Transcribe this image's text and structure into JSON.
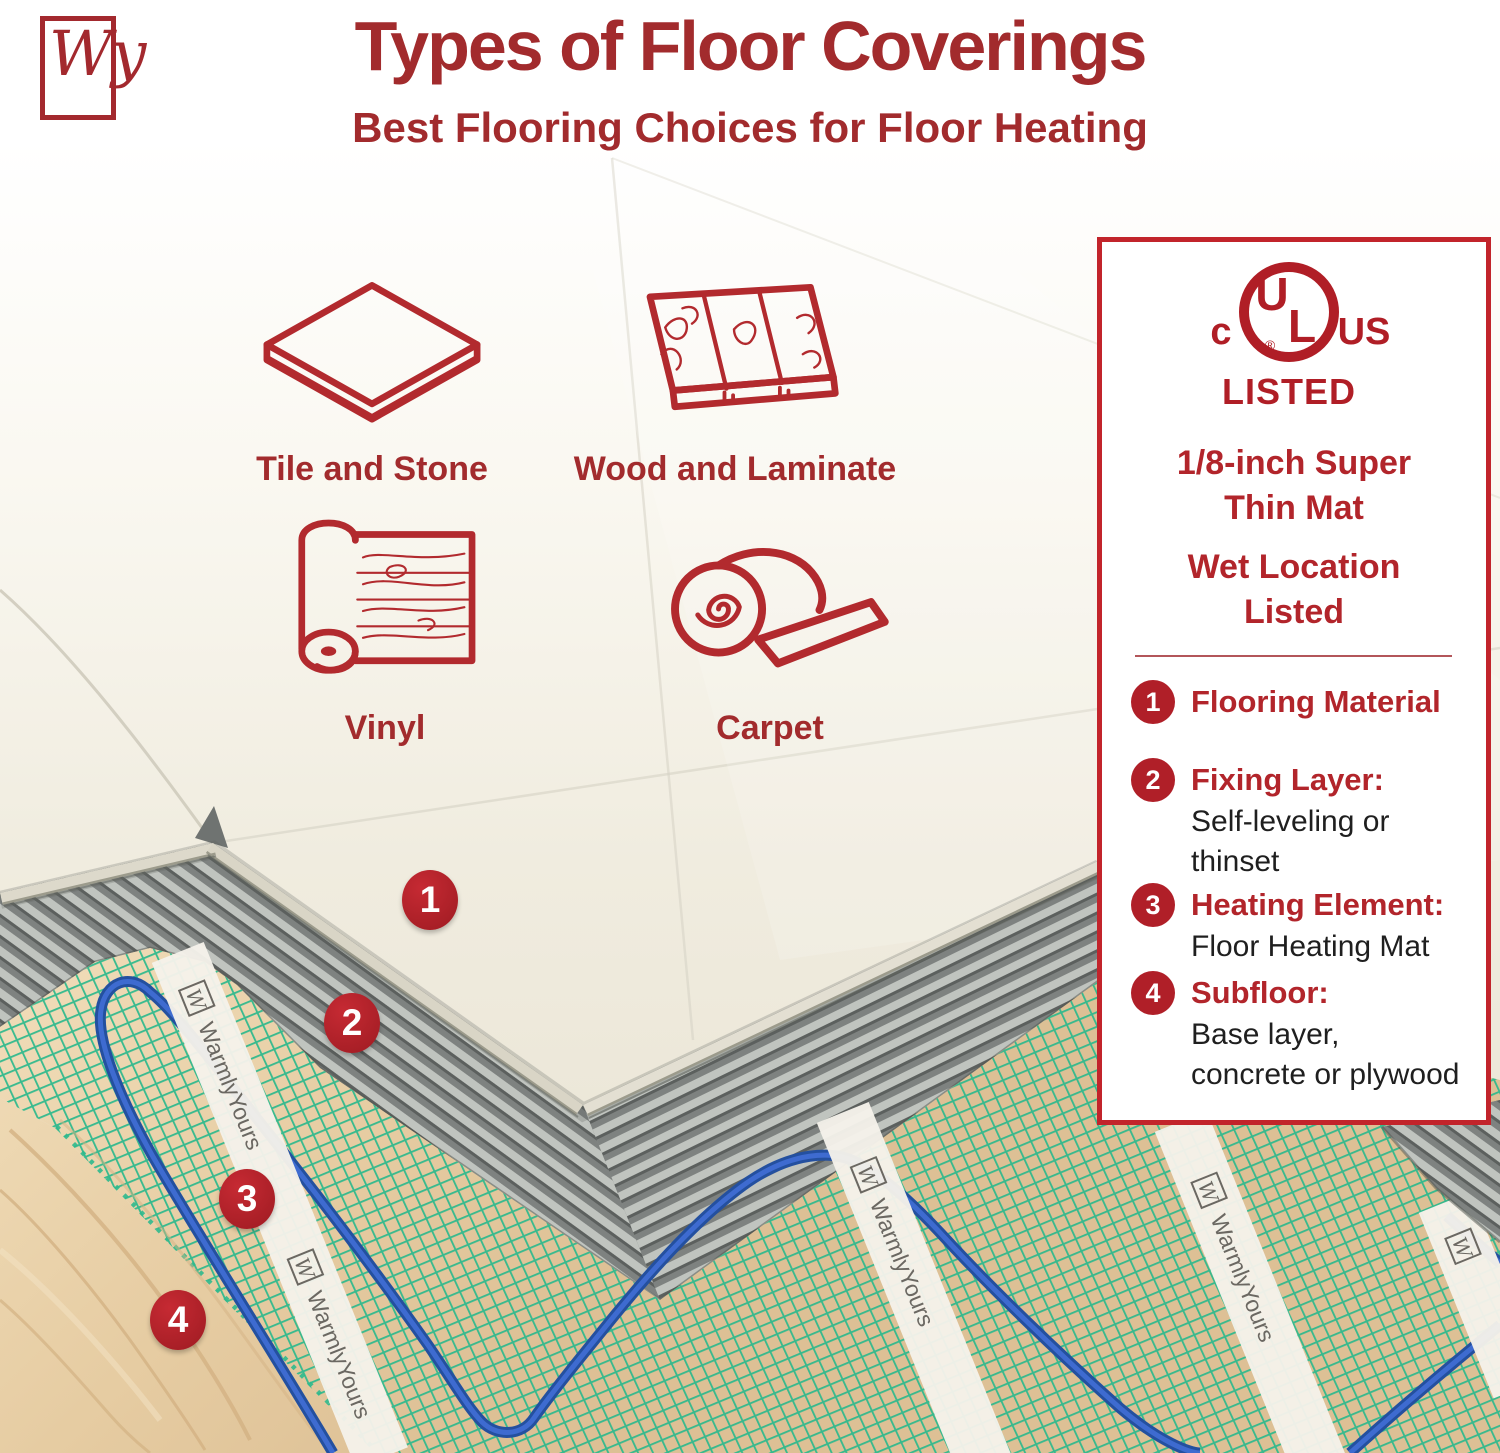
{
  "brand": {
    "logo_monogram": "Wy",
    "name": "WarmlyYours"
  },
  "header": {
    "title": "Types of Floor Coverings",
    "subtitle": "Best Flooring Choices for Floor Heating"
  },
  "flooring_types": [
    {
      "label": "Tile and Stone",
      "icon": "tile-and-stone-icon"
    },
    {
      "label": "Wood and Laminate",
      "icon": "wood-and-laminate-icon"
    },
    {
      "label": "Vinyl",
      "icon": "vinyl-roll-icon"
    },
    {
      "label": "Carpet",
      "icon": "carpet-roll-icon"
    }
  ],
  "panel": {
    "certification": {
      "c": "c",
      "u": "U",
      "l": "L",
      "reg": "®",
      "us": "US",
      "listed": "LISTED"
    },
    "mat_heading": {
      "line1": "1/8-inch Super",
      "line2": "Thin Mat"
    },
    "wet_heading": {
      "line1": "Wet Location",
      "line2": "Listed"
    }
  },
  "legend": {
    "items": [
      {
        "num": "1",
        "title": "Flooring Material",
        "body": ""
      },
      {
        "num": "2",
        "title": "Fixing Layer:",
        "body": "Self-leveling or thinset"
      },
      {
        "num": "3",
        "title": "Heating Element:",
        "body": "Floor Heating Mat"
      },
      {
        "num": "4",
        "title": "Subfloor:",
        "body": "Base layer, concrete or plywood"
      }
    ]
  },
  "diagram": {
    "markers": [
      {
        "num": "1"
      },
      {
        "num": "2"
      },
      {
        "num": "3"
      },
      {
        "num": "4"
      }
    ],
    "layers": [
      "Flooring Material (tile)",
      "Fixing layer thinset",
      "Heating mat with wire",
      "Plywood subfloor"
    ]
  },
  "colors": {
    "accent_red": "#A22B2D",
    "badge_red": "#B01F28",
    "panel_border": "#C2242B",
    "mesh_green": "#2FB98D",
    "wire_blue": "#2E5FC5",
    "thinset_gray": "#7E8280",
    "plywood_tan": "#E8CFA6",
    "tile_cream": "#EDE8DA"
  }
}
